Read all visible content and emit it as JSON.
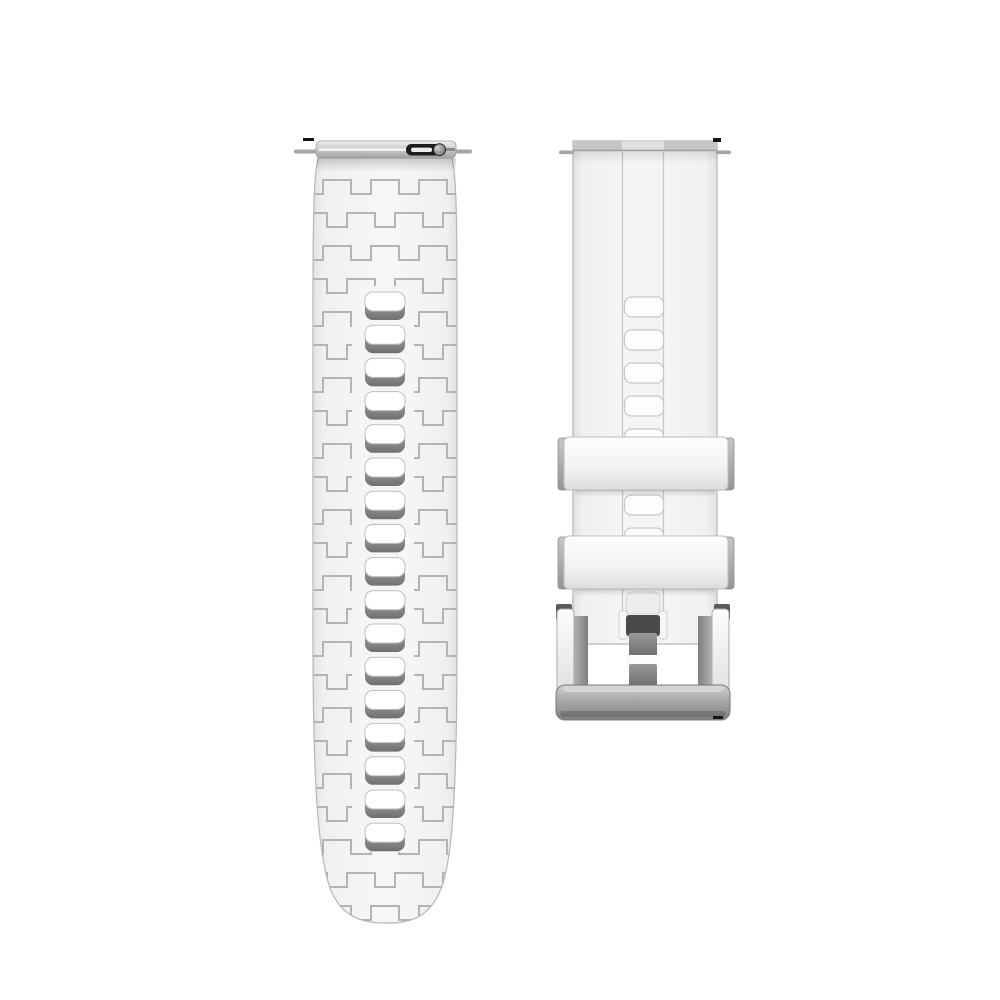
{
  "scene": {
    "type": "product-photo",
    "subject": "Two-piece white silicone quick-release watch band with silver pin buckle",
    "background_color": "#ffffff"
  },
  "colors": {
    "strap_face": "#f4f4f4",
    "strap_edge": "#b6b6b6",
    "texture_line": "#b4b4b4",
    "hole_fill": "#ffffff",
    "hole_shadow": "#8a8a8a",
    "channel_line": "#c6c6c6",
    "lever_black": "#1c1c1c",
    "pin_gray": "#a5a5a5",
    "slot_dark": "#4a4a4a",
    "hinge_dark": "#5a5a5a",
    "buckle_bar_gray": "#8f8f8f",
    "artifact_black": "#141414"
  },
  "left_strap": {
    "label": "textured strap half with adjustment holes",
    "hole_count": 17,
    "texture": "interlocking meander emboss",
    "spring_bar": {
      "visible": true,
      "quick_release_lever": true
    }
  },
  "right_strap": {
    "label": "buckle strap half",
    "visible_hole_count": 7,
    "keeper_count": 2,
    "buckle": {
      "style": "pin buckle",
      "finish": "silver"
    },
    "spring_bar": {
      "visible": true
    }
  }
}
